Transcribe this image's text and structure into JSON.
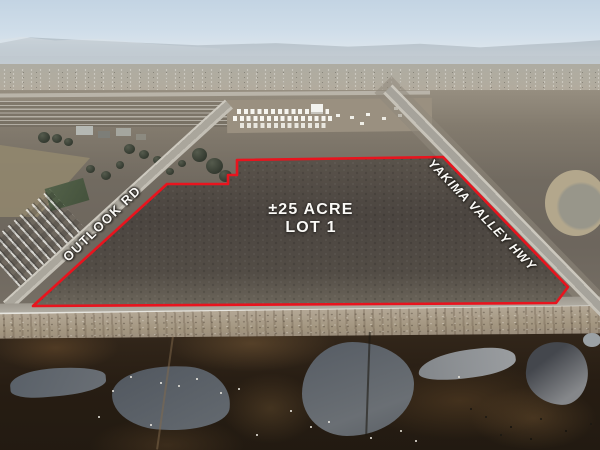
{
  "annotation": {
    "boundary_color": "#e8141e",
    "label_text_color": "#ffffff",
    "lot_label": {
      "line1": "±25 ACRE",
      "line2": "LOT 1"
    },
    "road_labels": {
      "west": "OUTLOOK RD",
      "east": "YAKIMA VALLEY HWY"
    }
  }
}
